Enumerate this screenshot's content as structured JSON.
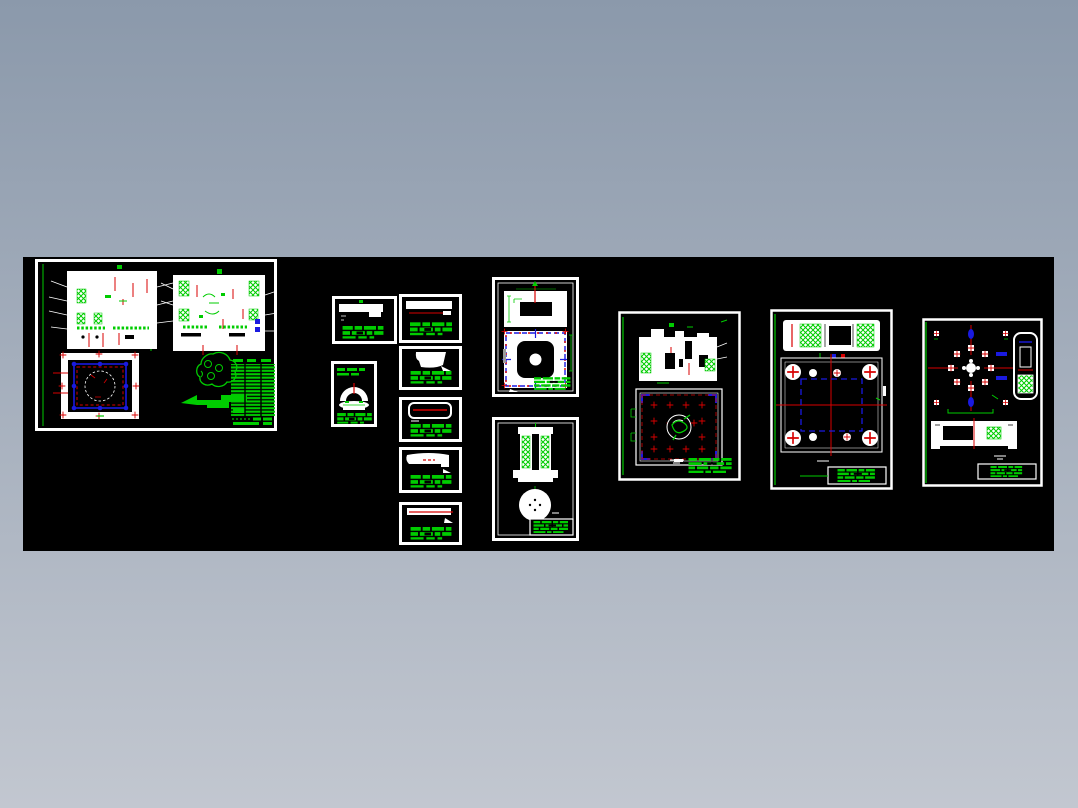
{
  "page": {
    "kind": "cad-multi-sheet-drawing-preview",
    "sheet_count": 13,
    "legible_text": ""
  },
  "colors": {
    "bg_top": "#8B99AB",
    "bg_bottom": "#C2C7D0",
    "canvas_bg": "#000000",
    "white": "#FFFFFF",
    "green": "#00CC00",
    "red": "#D80000",
    "blue": "#1A1AE0",
    "gray": "#9C9C9C"
  },
  "sheets": [
    {
      "id": "assembly",
      "name": "assembly-drawing-sheet"
    },
    {
      "id": "l1",
      "name": "small-part-sheet-1"
    },
    {
      "id": "l2",
      "name": "arch-part-sheet"
    },
    {
      "id": "r1",
      "name": "bar-part-sheet-1"
    },
    {
      "id": "r2",
      "name": "blob-part-sheet"
    },
    {
      "id": "r3",
      "name": "ring-part-sheet"
    },
    {
      "id": "r4",
      "name": "bar-part-sheet-2"
    },
    {
      "id": "r5",
      "name": "bar-part-sheet-3"
    },
    {
      "id": "m1",
      "name": "cavity-plate-sheet"
    },
    {
      "id": "m2",
      "name": "column-and-disc-sheet"
    },
    {
      "id": "n",
      "name": "core-plate-sheet"
    },
    {
      "id": "o",
      "name": "clamping-plate-sheet"
    },
    {
      "id": "p",
      "name": "ejector-plate-sheet"
    }
  ]
}
